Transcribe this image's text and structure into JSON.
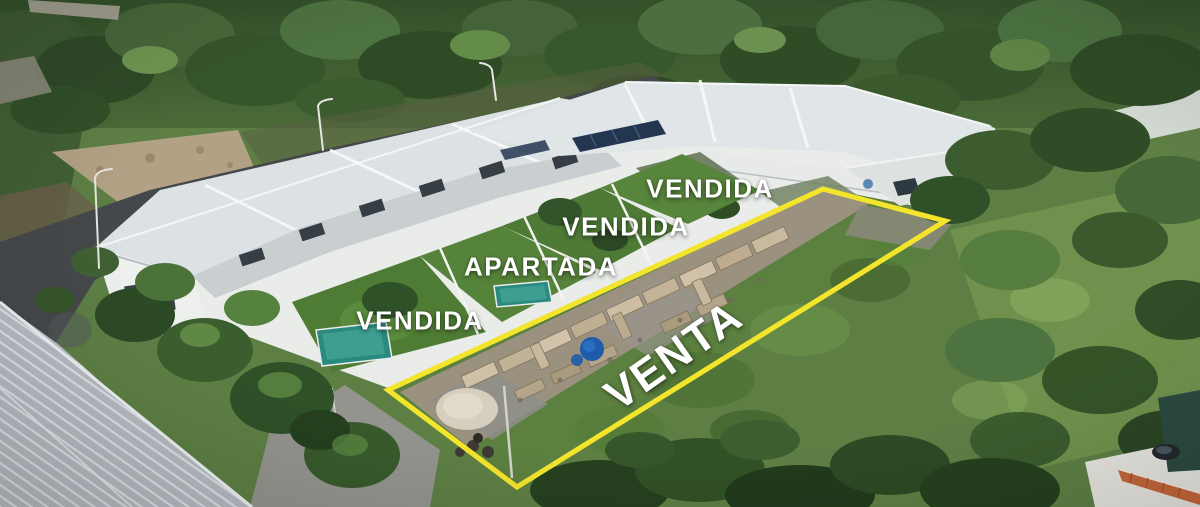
{
  "overlay": {
    "outline_color": "#f3e42c",
    "label_color": "#ffffff",
    "lot_outline_points": "388,390 823,189 945,221 517,487",
    "labels": [
      {
        "id": "vendida-top",
        "text": "VENDIDA"
      },
      {
        "id": "vendida-middle",
        "text": "VENDIDA"
      },
      {
        "id": "apartada",
        "text": "APARTADA"
      },
      {
        "id": "vendida-left",
        "text": "VENDIDA"
      },
      {
        "id": "venta",
        "text": "VENTA"
      }
    ]
  }
}
